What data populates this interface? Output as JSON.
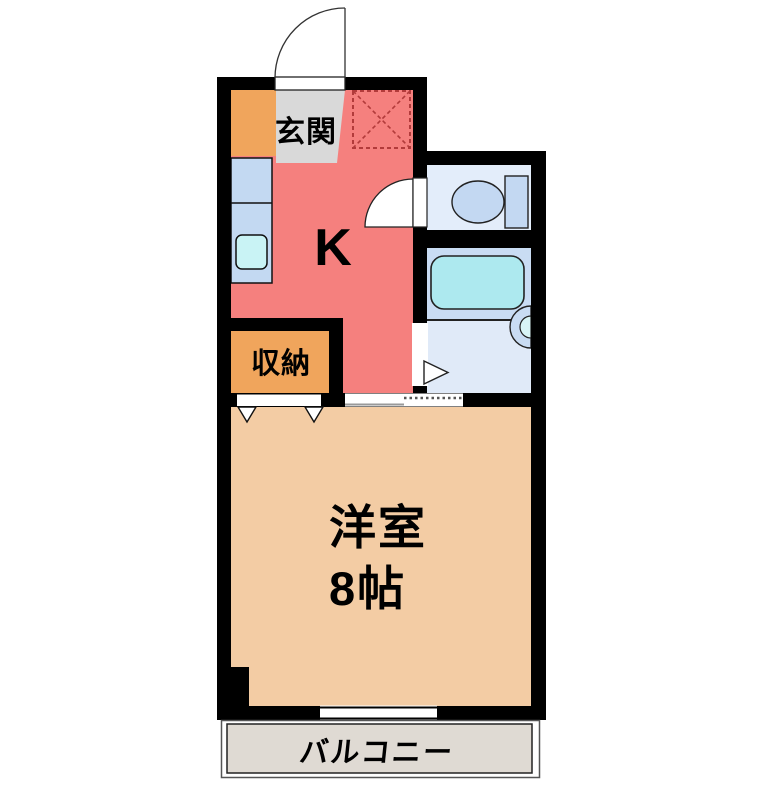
{
  "floorplan": {
    "background_color": "#FFFFFF",
    "wall_color": "#000000",
    "rooms": {
      "genkan": {
        "label": "玄関",
        "color": "#D9D9D9"
      },
      "kitchen": {
        "label": "K",
        "color": "#F5807E"
      },
      "storage": {
        "label": "収納",
        "color": "#F0A55C"
      },
      "entry_cabinet": {
        "color": "#F0A55C"
      },
      "toilet": {
        "color": "#E3EDFA"
      },
      "bathroom": {
        "color": "#E0EAF8",
        "band_color": "#C9DCF3"
      },
      "western_room": {
        "label": "洋室",
        "size": "8帖",
        "color": "#F3CCA4"
      },
      "balcony": {
        "label": "バルコニー",
        "color": "#DFDAD3"
      }
    },
    "fixtures": {
      "counter_color": "#C3D9F2",
      "sink_color": "#C9F3F5",
      "bathtub_color": "#ADE9EF",
      "toilet_color": "#C3D8F2",
      "washbasin_color": "#C9DCF3",
      "washbasin_bowl_color": "#D8F4F6"
    },
    "symbols": {
      "dashed_square_color": "#B23B3B"
    }
  }
}
